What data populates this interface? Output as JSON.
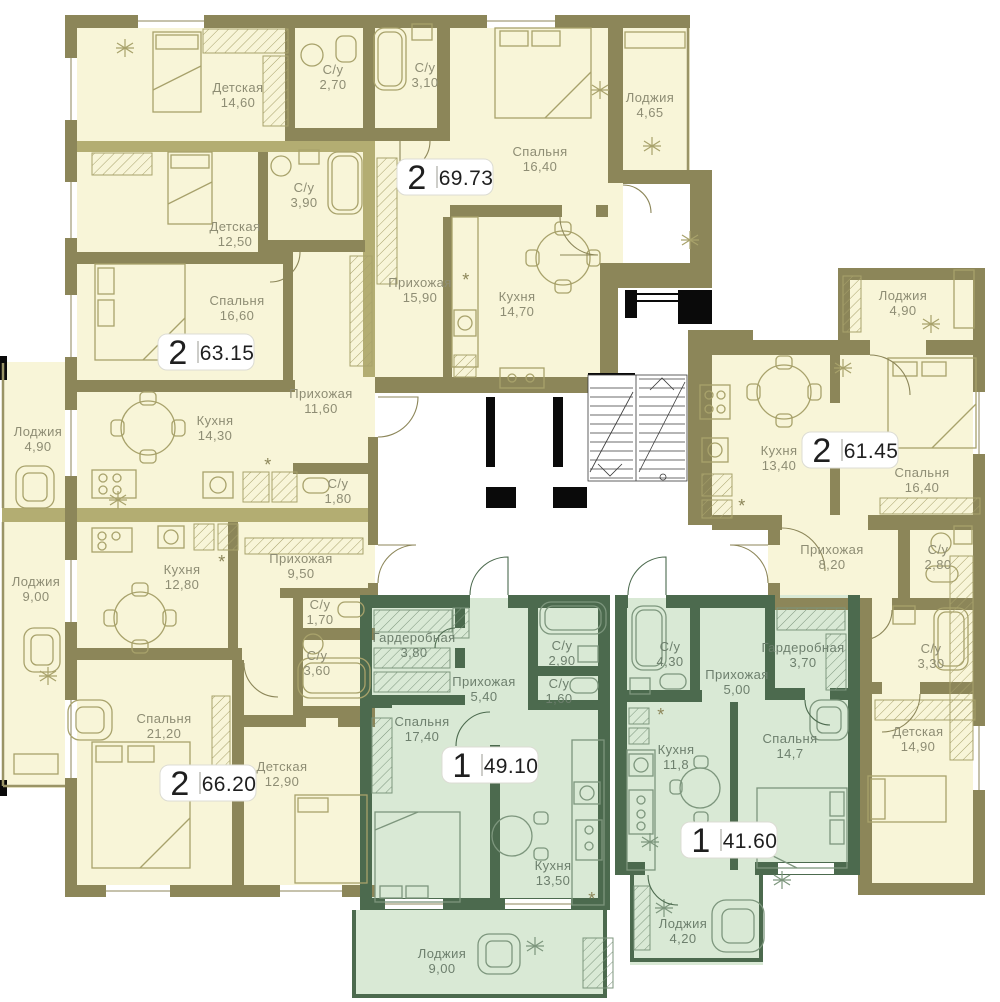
{
  "plan": {
    "colors": {
      "cream_floor": "#f8f5d8",
      "olive_wall": "#8c8659",
      "olive_wall_light": "#b3ad72",
      "green_floor": "#d9e9d5",
      "green_wall": "#4c6a4e",
      "cream_label": "#8e8d74",
      "green_label": "#6d7f6d",
      "badge_bg": "#ffffff",
      "badge_text": "#1f1f1f",
      "black": "#0a0a0a"
    },
    "vent_symbol": "*",
    "vent_marks": [
      {
        "x": 466,
        "y": 286
      },
      {
        "x": 268,
        "y": 471
      },
      {
        "x": 222,
        "y": 568
      },
      {
        "x": 742,
        "y": 512
      },
      {
        "x": 661,
        "y": 721
      },
      {
        "x": 592,
        "y": 905
      }
    ],
    "apartments": [
      {
        "id": "69-73",
        "scheme": "cream",
        "badge": {
          "rooms_count": "2",
          "area_total": "69.73",
          "x": 445,
          "y": 177
        },
        "rooms": [
          {
            "name": "Детская",
            "area": "14,60",
            "x": 238,
            "y": 92
          },
          {
            "name": "С/у",
            "area": "2,70",
            "x": 333,
            "y": 74
          },
          {
            "name": "С/у",
            "area": "3,10",
            "x": 425,
            "y": 72
          },
          {
            "name": "Спальня",
            "area": "16,40",
            "x": 540,
            "y": 156
          },
          {
            "name": "Лоджия",
            "area": "4,65",
            "x": 650,
            "y": 102
          },
          {
            "name": "Прихожая",
            "area": "15,90",
            "x": 420,
            "y": 287
          },
          {
            "name": "Кухня",
            "area": "14,70",
            "x": 517,
            "y": 301
          }
        ]
      },
      {
        "id": "63-15",
        "scheme": "cream",
        "badge": {
          "rooms_count": "2",
          "area_total": "63.15",
          "x": 206,
          "y": 352
        },
        "rooms": [
          {
            "name": "Детская",
            "area": "12,50",
            "x": 235,
            "y": 231
          },
          {
            "name": "С/у",
            "area": "3,90",
            "x": 304,
            "y": 192
          },
          {
            "name": "Спальня",
            "area": "16,60",
            "x": 237,
            "y": 305
          },
          {
            "name": "Кухня",
            "area": "14,30",
            "x": 215,
            "y": 425
          },
          {
            "name": "Прихожая",
            "area": "11,60",
            "x": 321,
            "y": 398
          },
          {
            "name": "С/у",
            "area": "1,80",
            "x": 338,
            "y": 488
          },
          {
            "name": "Лоджия",
            "area": "4,90",
            "x": 38,
            "y": 436
          }
        ]
      },
      {
        "id": "66-20",
        "scheme": "cream",
        "badge": {
          "rooms_count": "2",
          "area_total": "66.20",
          "x": 208,
          "y": 783
        },
        "rooms": [
          {
            "name": "Лоджия",
            "area": "9,00",
            "x": 36,
            "y": 586
          },
          {
            "name": "Кухня",
            "area": "12,80",
            "x": 182,
            "y": 574
          },
          {
            "name": "Прихожая",
            "area": "9,50",
            "x": 301,
            "y": 563
          },
          {
            "name": "С/у",
            "area": "1,70",
            "x": 320,
            "y": 609
          },
          {
            "name": "С/у",
            "area": "3,60",
            "x": 317,
            "y": 660
          },
          {
            "name": "Спальня",
            "area": "21,20",
            "x": 164,
            "y": 723
          },
          {
            "name": "Детская",
            "area": "12,90",
            "x": 282,
            "y": 771
          }
        ]
      },
      {
        "id": "61-45",
        "scheme": "cream",
        "badge": {
          "rooms_count": "2",
          "area_total": "61.45",
          "x": 850,
          "y": 450
        },
        "rooms": [
          {
            "name": "Лоджия",
            "area": "4,90",
            "x": 903,
            "y": 300
          },
          {
            "name": "Кухня",
            "area": "13,40",
            "x": 779,
            "y": 455
          },
          {
            "name": "Спальня",
            "area": "16,40",
            "x": 922,
            "y": 477
          },
          {
            "name": "Прихожая",
            "area": "8,20",
            "x": 832,
            "y": 554
          },
          {
            "name": "С/у",
            "area": "2,80",
            "x": 938,
            "y": 554
          },
          {
            "name": "С/у",
            "area": "3,30",
            "x": 931,
            "y": 653
          },
          {
            "name": "Детская",
            "area": "14,90",
            "x": 918,
            "y": 736
          }
        ]
      },
      {
        "id": "49-10",
        "scheme": "green",
        "badge": {
          "rooms_count": "1",
          "area_total": "49.10",
          "x": 490,
          "y": 765
        },
        "rooms": [
          {
            "name": "Гардеробная",
            "area": "3,80",
            "x": 414,
            "y": 642
          },
          {
            "name": "Прихожая",
            "area": "5,40",
            "x": 484,
            "y": 686
          },
          {
            "name": "С/у",
            "area": "2,90",
            "x": 562,
            "y": 650
          },
          {
            "name": "С/у",
            "area": "1,60",
            "x": 559,
            "y": 688
          },
          {
            "name": "Спальня",
            "area": "17,40",
            "x": 422,
            "y": 726
          },
          {
            "name": "Кухня",
            "area": "13,50",
            "x": 553,
            "y": 870
          },
          {
            "name": "Лоджия",
            "area": "9,00",
            "x": 442,
            "y": 958
          }
        ]
      },
      {
        "id": "41-60",
        "scheme": "green",
        "badge": {
          "rooms_count": "1",
          "area_total": "41.60",
          "x": 729,
          "y": 840
        },
        "rooms": [
          {
            "name": "С/у",
            "area": "4,30",
            "x": 670,
            "y": 651
          },
          {
            "name": "Прихожая",
            "area": "5,00",
            "x": 737,
            "y": 679
          },
          {
            "name": "Гардеробная",
            "area": "3,70",
            "x": 803,
            "y": 652
          },
          {
            "name": "Кухня",
            "area": "11,8",
            "x": 676,
            "y": 754
          },
          {
            "name": "Спальня",
            "area": "14,7",
            "x": 790,
            "y": 743
          },
          {
            "name": "Лоджия",
            "area": "4,20",
            "x": 683,
            "y": 928
          }
        ]
      }
    ]
  }
}
